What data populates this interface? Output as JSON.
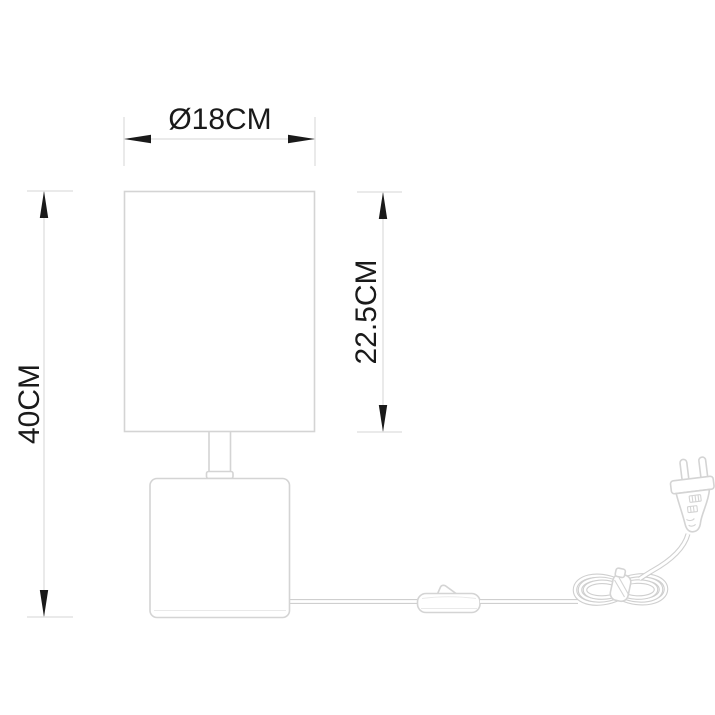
{
  "drawing": {
    "type": "product-dimension-diagram",
    "colors": {
      "outline": "#d4d4d4",
      "dimension-line": "#dedede",
      "text": "#1a1a1a",
      "arrow": "#1a1a1a",
      "cord": "#cfcfcf",
      "background": "#ffffff"
    },
    "dimensions": {
      "shade_diameter": {
        "label": "Ø18CM"
      },
      "shade_height": {
        "label": "22.5CM"
      },
      "total_height": {
        "label": "40CM"
      }
    },
    "parts": [
      "lamp-shade",
      "lamp-stem",
      "lamp-base",
      "power-cord",
      "inline-switch",
      "cord-coil",
      "eu-plug"
    ]
  }
}
